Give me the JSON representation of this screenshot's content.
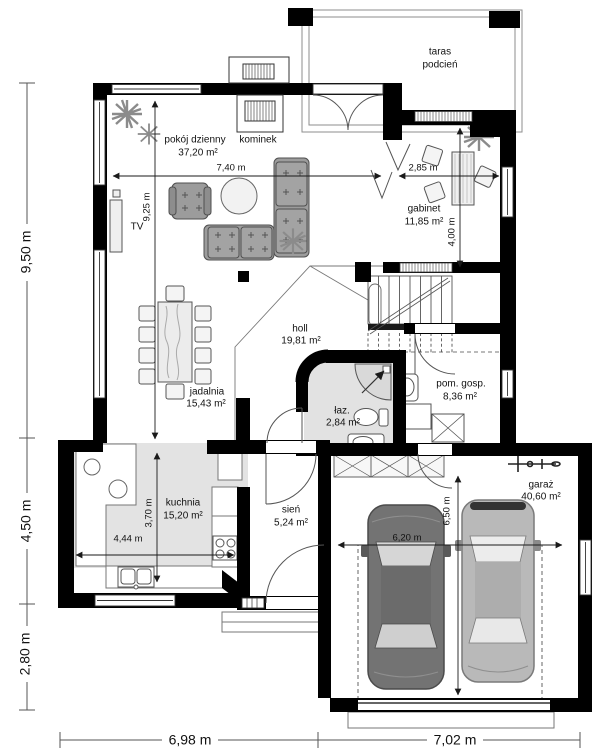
{
  "rooms": {
    "taras": {
      "line1": "taras",
      "line2": "podcień"
    },
    "pokoj": {
      "name": "pokój dzienny",
      "area": "37,20 m²"
    },
    "kominek": {
      "name": "kominek"
    },
    "gabinet": {
      "name": "gabinet",
      "area": "11,85 m²"
    },
    "holl": {
      "name": "holl",
      "area": "19,81 m²"
    },
    "jadalnia": {
      "name": "jadalnia",
      "area": "15,43 m²"
    },
    "lazienka": {
      "name": "łaz.",
      "area": "2,84 m²"
    },
    "pom_gosp": {
      "name": "pom. gosp.",
      "area": "8,36 m²"
    },
    "kuchnia": {
      "name": "kuchnia",
      "area": "15,20 m²"
    },
    "sien": {
      "name": "sień",
      "area": "5,24 m²"
    },
    "garaz": {
      "name": "garaż",
      "area": "40,60 m²"
    },
    "tv": {
      "name": "TV"
    }
  },
  "dimensions": {
    "interior": {
      "living_width": "7,40 m",
      "living_height": "9,25 m",
      "gabinet_width": "2,85 m",
      "gabinet_height": "4,00 m",
      "kitchen_width": "4,44 m",
      "kitchen_height": "3,70 m",
      "garage_width": "6,20 m",
      "garage_height": "6,50 m"
    },
    "exterior": {
      "left_top": "9,50 m",
      "left_middle": "4,50 m",
      "left_bottom": "2,80 m",
      "bottom_left": "6,98 m",
      "bottom_right": "7,02 m"
    }
  },
  "colors": {
    "wall": "#000000",
    "furniture": "#9c9c9c",
    "floor_light": "#e3e3e3",
    "car_dark": "#737373",
    "car_light": "#b9b9b9"
  }
}
